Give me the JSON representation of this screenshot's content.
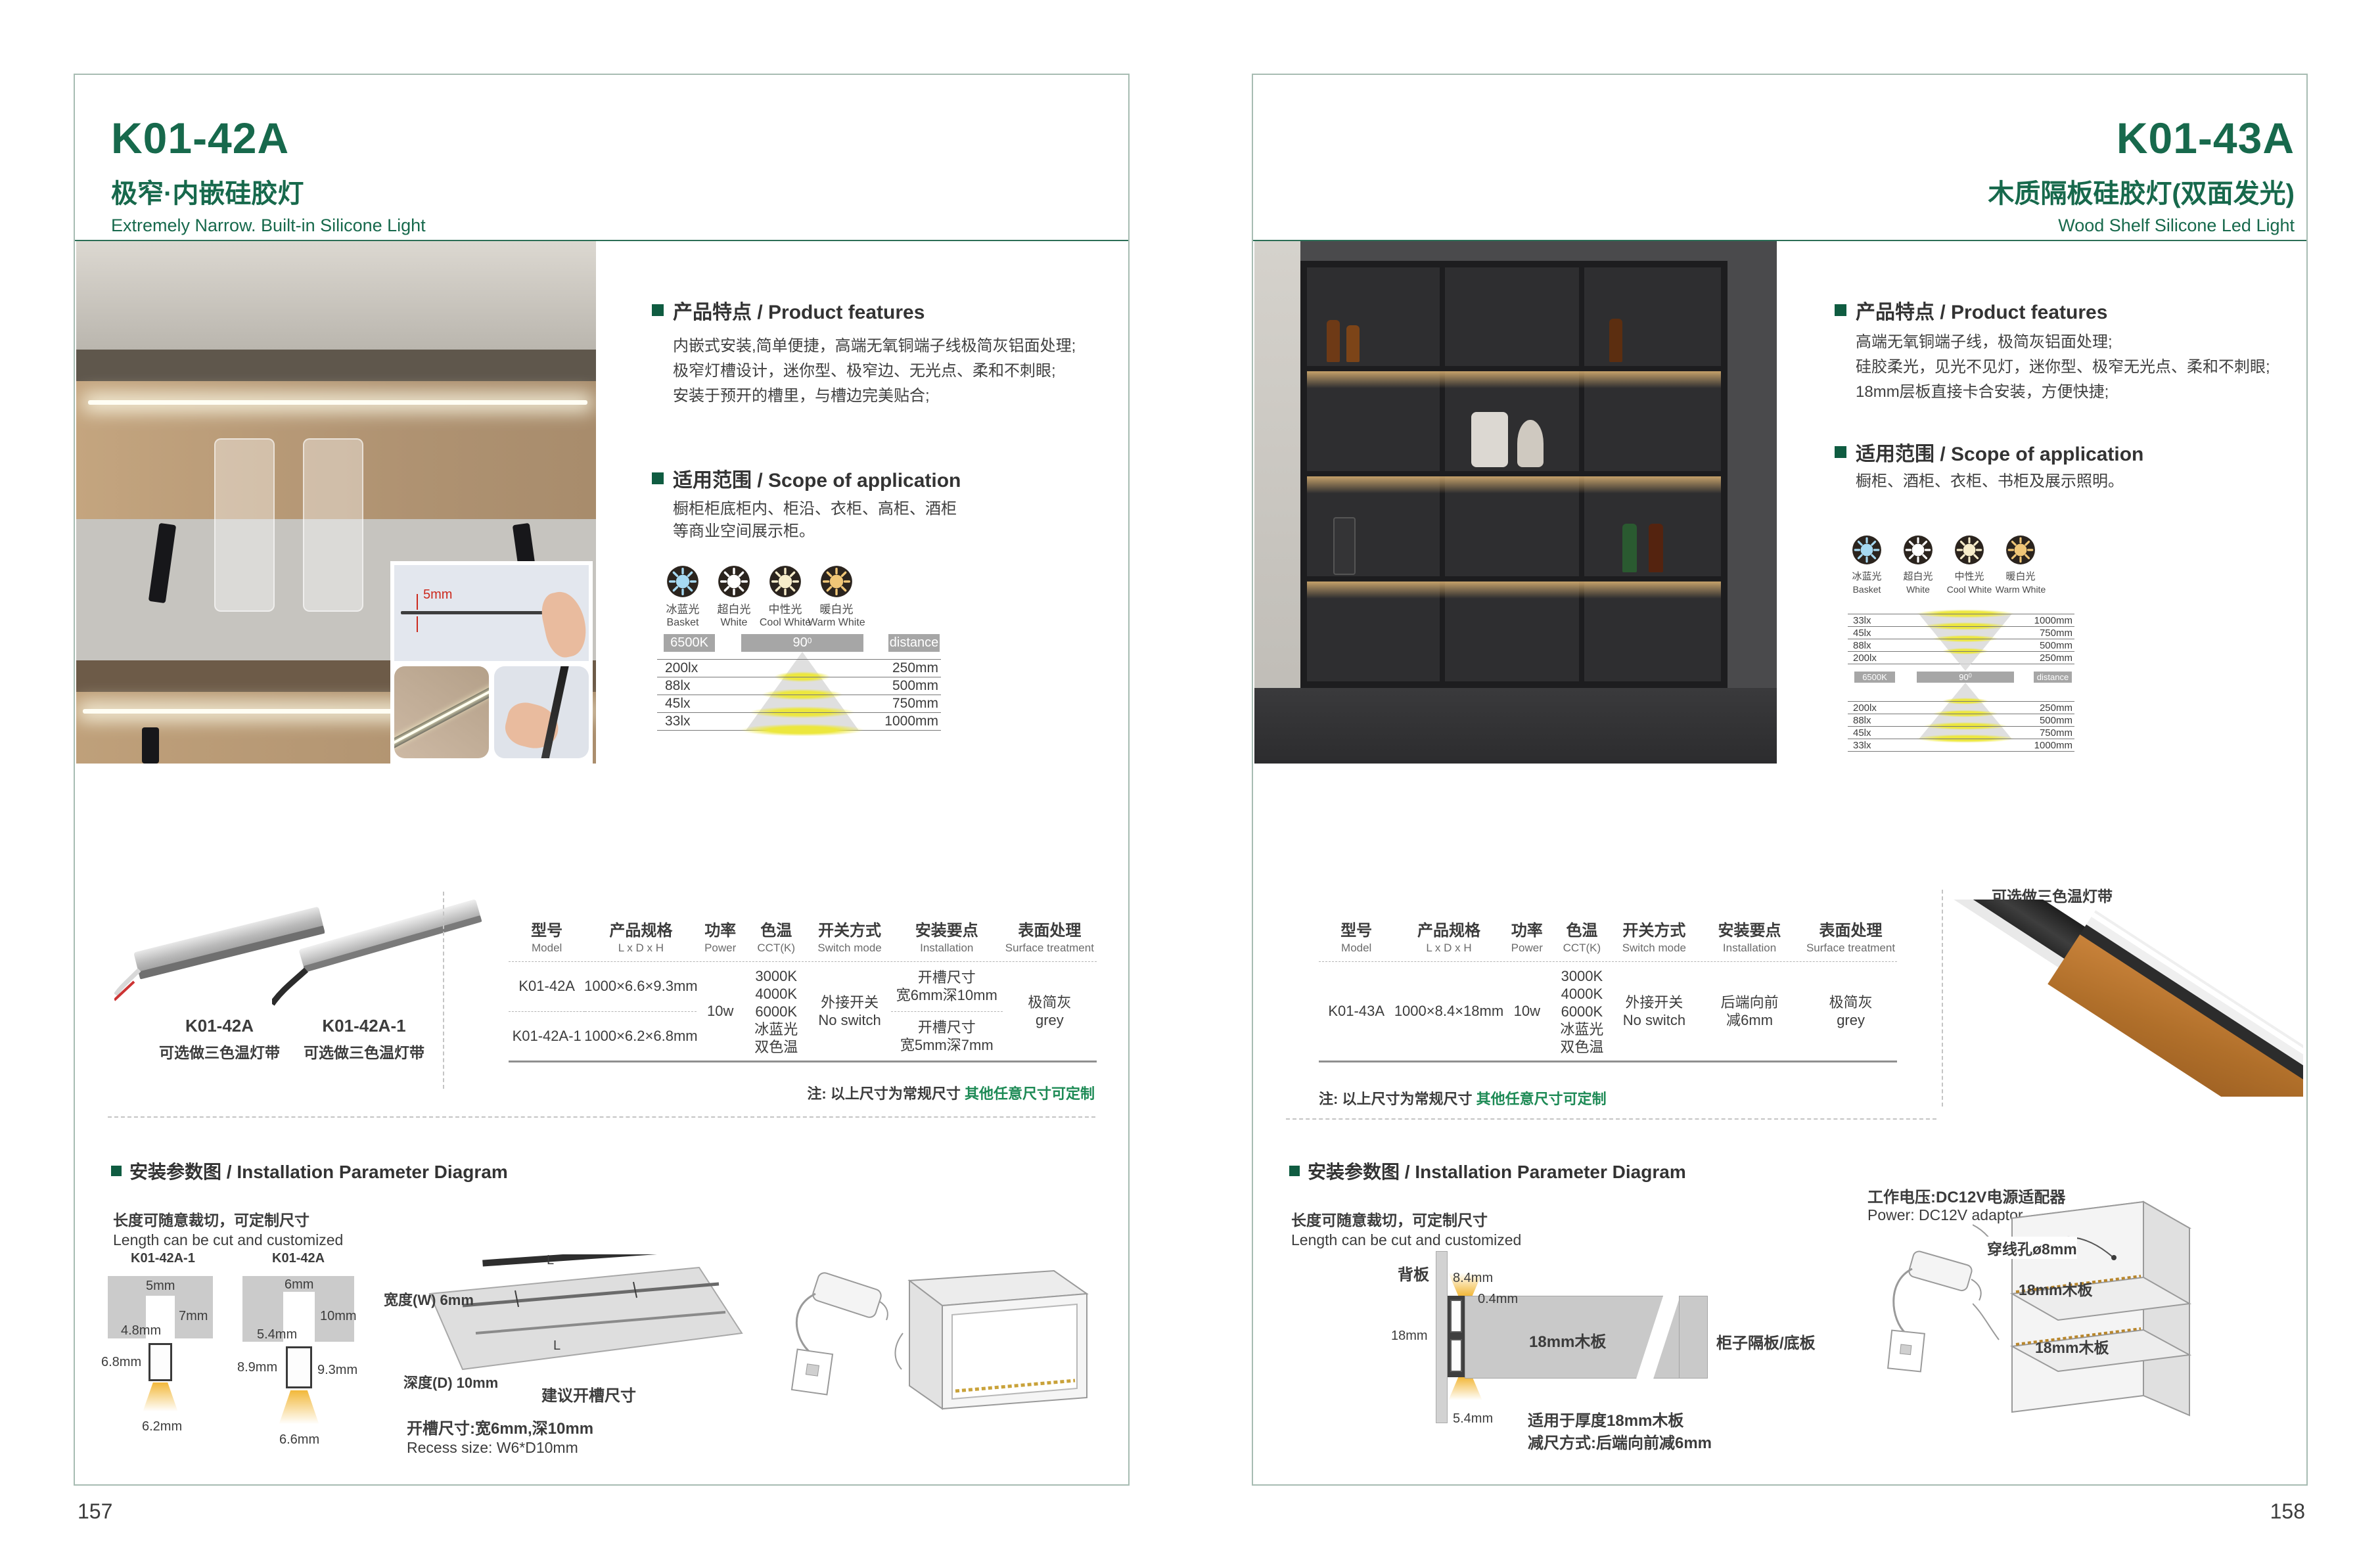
{
  "left": {
    "page_number": "157",
    "model": "K01-42A",
    "subtitle_zh": "极窄·内嵌硅胶灯",
    "subtitle_en": "Extremely Narrow. Built-in Silicone Light",
    "inset_dim": "5mm",
    "features_heading": "产品特点 / Product features",
    "features_lines": [
      "内嵌式安装,简单便捷，高端无氧铜端子线极简灰铝面处理;",
      "极窄灯槽设计，迷你型、极窄边、无光点、柔和不刺眼;",
      "安装于预开的槽里，与槽边完美贴合;"
    ],
    "scope_heading": "适用范围 / Scope of application",
    "scope_lines": [
      "橱柜柜底柜内、柜沿、衣柜、高柜、酒柜",
      "等商业空间展示柜。"
    ],
    "cct_items": [
      {
        "zh": "冰蓝光",
        "en": "Basket",
        "color": "#a6d9f2"
      },
      {
        "zh": "超白光",
        "en": "White",
        "color": "#ffffff"
      },
      {
        "zh": "中性光",
        "en": "Cool White",
        "color": "#f6ecca"
      },
      {
        "zh": "暖白光",
        "en": "Warm White",
        "color": "#f0c677"
      }
    ],
    "chart": {
      "kelvin": "6500K",
      "angle": "90",
      "angle_sup": "0",
      "distance": "distance",
      "rows": [
        {
          "lx": "200lx",
          "mm": "250mm"
        },
        {
          "lx": "88lx",
          "mm": "500mm"
        },
        {
          "lx": "45lx",
          "mm": "750mm"
        },
        {
          "lx": "33lx",
          "mm": "1000mm"
        }
      ]
    },
    "products": [
      {
        "model": "K01-42A",
        "caption": "可选做三色温灯带"
      },
      {
        "model": "K01-42A-1",
        "caption": "可选做三色温灯带"
      }
    ],
    "table": {
      "headers": [
        {
          "zh": "型号",
          "en": "Model"
        },
        {
          "zh": "产品规格",
          "en": "L x D x H"
        },
        {
          "zh": "功率",
          "en": "Power"
        },
        {
          "zh": "色温",
          "en": "CCT(K)"
        },
        {
          "zh": "开关方式",
          "en": "Switch mode"
        },
        {
          "zh": "安装要点",
          "en": "Installation"
        },
        {
          "zh": "表面处理",
          "en": "Surface treatment"
        }
      ],
      "row1_model": "K01-42A",
      "row1_size": "1000×6.6×9.3mm",
      "row2_model": "K01-42A-1",
      "row2_size": "1000×6.2×6.8mm",
      "power": "10w",
      "cct_lines": [
        "3000K",
        "4000K",
        "6000K",
        "冰蓝光",
        "双色温"
      ],
      "switch_lines": [
        "外接开关",
        "No switch"
      ],
      "install_row1": [
        "开槽尺寸",
        "宽6mm深10mm"
      ],
      "install_row2": [
        "开槽尺寸",
        "宽5mm深7mm"
      ],
      "surface_lines": [
        "极简灰",
        "grey"
      ]
    },
    "note_dark": "注: 以上尺寸为常规尺寸 ",
    "note_green": "其他任意尺寸可定制",
    "install": {
      "heading": "安装参数图 / Installation Parameter Diagram",
      "sub_zh": "长度可随意裁切，可定制尺寸",
      "sub_en": "Length can be cut and customized",
      "d1_label": "K01-42A-1",
      "d1": {
        "top": "5mm",
        "depth": "7mm",
        "inner": "4.8mm",
        "h": "6.8mm",
        "bottom": "6.2mm"
      },
      "d2_label": "K01-42A",
      "d2": {
        "top": "6mm",
        "depth": "10mm",
        "inner": "5.4mm",
        "h": "8.9mm",
        "h2": "9.3mm",
        "bottom": "6.6mm"
      },
      "slab_w": "宽度(W) 6mm",
      "slab_d": "深度(D) 10mm",
      "slab_suggest": "建议开槽尺寸",
      "slab_l": "L",
      "recess_zh": "开槽尺寸:宽6mm,深10mm",
      "recess_en": "Recess size: W6*D10mm"
    }
  },
  "right": {
    "page_number": "158",
    "model": "K01-43A",
    "subtitle_zh": "木质隔板硅胶灯(双面发光)",
    "subtitle_en": "Wood Shelf Silicone Led Light",
    "features_heading": "产品特点 / Product features",
    "features_lines": [
      "高端无氧铜端子线，极简灰铝面处理;",
      "硅胶柔光，见光不见灯，迷你型、极窄无光点、柔和不刺眼;",
      "18mm层板直接卡合安装，方便快捷;"
    ],
    "scope_heading": "适用范围 / Scope of application",
    "scope_lines": [
      "橱柜、酒柜、衣柜、书柜及展示照明。"
    ],
    "cct_items": [
      {
        "zh": "冰蓝光",
        "en": "Basket",
        "color": "#a6d9f2"
      },
      {
        "zh": "超白光",
        "en": "White",
        "color": "#ffffff"
      },
      {
        "zh": "中性光",
        "en": "Cool White",
        "color": "#f6ecca"
      },
      {
        "zh": "暖白光",
        "en": "Warm White",
        "color": "#f0c677"
      }
    ],
    "chart": {
      "kelvin": "6500K",
      "angle": "90",
      "angle_sup": "0",
      "distance": "distance",
      "rows_top": [
        {
          "lx": "33lx",
          "mm": "1000mm"
        },
        {
          "lx": "45lx",
          "mm": "750mm"
        },
        {
          "lx": "88lx",
          "mm": "500mm"
        },
        {
          "lx": "200lx",
          "mm": "250mm"
        }
      ],
      "rows_bottom": [
        {
          "lx": "200lx",
          "mm": "250mm"
        },
        {
          "lx": "88lx",
          "mm": "500mm"
        },
        {
          "lx": "45lx",
          "mm": "750mm"
        },
        {
          "lx": "33lx",
          "mm": "1000mm"
        }
      ]
    },
    "product_caption": "可选做三色温灯带",
    "table": {
      "headers": [
        {
          "zh": "型号",
          "en": "Model"
        },
        {
          "zh": "产品规格",
          "en": "L x D x H"
        },
        {
          "zh": "功率",
          "en": "Power"
        },
        {
          "zh": "色温",
          "en": "CCT(K)"
        },
        {
          "zh": "开关方式",
          "en": "Switch mode"
        },
        {
          "zh": "安装要点",
          "en": "Installation"
        },
        {
          "zh": "表面处理",
          "en": "Surface treatment"
        }
      ],
      "row_model": "K01-43A",
      "row_size": "1000×8.4×18mm",
      "power": "10w",
      "cct_lines": [
        "3000K",
        "4000K",
        "6000K",
        "冰蓝光",
        "双色温"
      ],
      "switch_lines": [
        "外接开关",
        "No switch"
      ],
      "install_lines": [
        "后端向前",
        "减6mm"
      ],
      "surface_lines": [
        "极简灰",
        "grey"
      ]
    },
    "note_dark": "注: 以上尺寸为常规尺寸 ",
    "note_green": "其他任意尺寸可定制",
    "install": {
      "heading": "安装参数图 / Installation Parameter Diagram",
      "sub_zh": "长度可随意裁切，可定制尺寸",
      "sub_en": "Length can be cut and customized",
      "back_panel": "背板",
      "dim_a": "8.4mm",
      "dim_b": "0.4mm",
      "dim_c": "18mm",
      "dim_d": "5.4mm",
      "board_label": "18mm木板",
      "side_label": "柜子隔板/底板",
      "fit_line1": "适用于厚度18mm木板",
      "fit_line2": "减尺方式:后端向前减6mm",
      "power_zh": "工作电压:DC12V电源适配器",
      "power_en": "Power: DC12V adaptor",
      "hole_label": "穿线孔ø8mm",
      "shelf_label1": "18mm木板",
      "shelf_label2": "18mm木板"
    }
  }
}
